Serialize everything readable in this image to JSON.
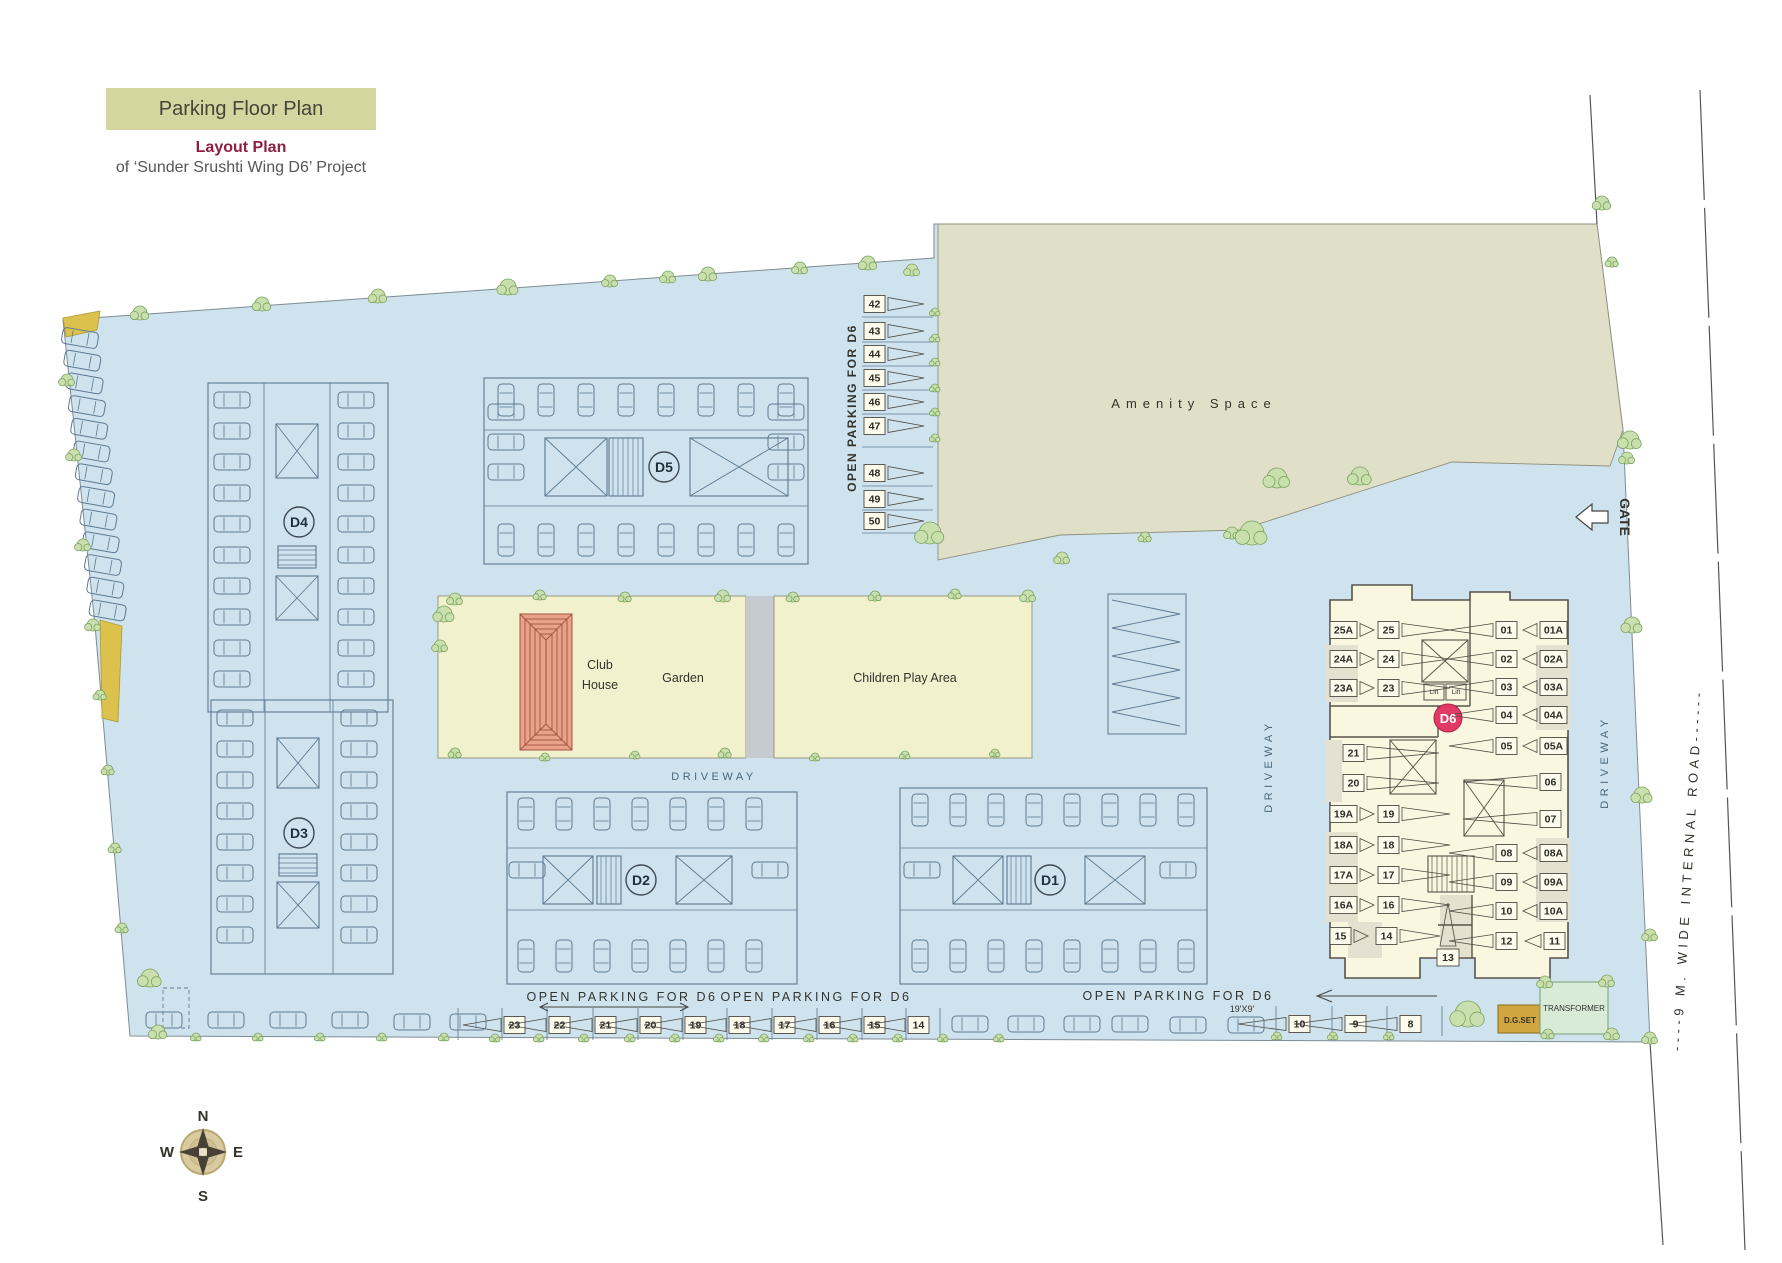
{
  "header": {
    "banner": "Parking Floor Plan",
    "subtitle_1": "Layout Plan",
    "subtitle_2": "of ‘Sunder Srushti Wing D6’ Project"
  },
  "labels": {
    "amenity_space": "Amenity Space",
    "club_house": [
      "Club",
      "House"
    ],
    "garden": "Garden",
    "children_play_area": "Children Play Area",
    "driveway": "DRIVEWAY",
    "gate": "GATE",
    "internal_road": "----9 M. WIDE INTERNAL ROAD------",
    "open_parking_for_d6": "OPEN PARKING FOR D6",
    "spot_dimension": "19'X9'",
    "dg_set": "D.G.SET",
    "transformer": "TRANSFORMER",
    "lift": "Lift"
  },
  "compass": {
    "north": "N",
    "east": "E",
    "south": "S",
    "west": "W"
  },
  "building_labels": {
    "d1": "D1",
    "d2": "D2",
    "d3": "D3",
    "d4": "D4",
    "d5": "D5",
    "d6": "D6"
  },
  "open_parking": {
    "side_column_spots": [
      "42",
      "43",
      "44",
      "45",
      "46",
      "47",
      "48",
      "49",
      "50"
    ],
    "bottom_row_spots": [
      "23",
      "22",
      "21",
      "20",
      "19",
      "18",
      "17",
      "16",
      "15",
      "14"
    ],
    "bottom_right_spots": [
      "10",
      "9",
      "8"
    ]
  },
  "d6_parking": {
    "top_left_spots": [
      [
        "25A",
        "25"
      ],
      [
        "24A",
        "24"
      ],
      [
        "23A",
        "23"
      ]
    ],
    "lower_left_spots": [
      [
        "21"
      ],
      [
        "20"
      ],
      [
        "19A",
        "19"
      ],
      [
        "18A",
        "18"
      ],
      [
        "17A",
        "17"
      ],
      [
        "16A",
        "16"
      ],
      [
        "15",
        "14"
      ]
    ],
    "center_spot": "13",
    "right_spots": [
      [
        "01",
        "01A"
      ],
      [
        "02",
        "02A"
      ],
      [
        "03",
        "03A"
      ],
      [
        "04",
        "04A"
      ],
      [
        "05",
        "05A"
      ],
      [
        "06"
      ],
      [
        "07"
      ],
      [
        "08",
        "08A"
      ],
      [
        "09",
        "09A"
      ],
      [
        "10",
        "10A"
      ],
      [
        "12",
        "11"
      ]
    ]
  },
  "colors": {
    "site": "#cfe3ee",
    "amenity": "#e0dfc8",
    "lawn": "#f1f2cd",
    "path": "#c6cbd0",
    "d6_fill": "#faf7e0",
    "d6_shaded": "#e5e1d0",
    "badge": "#e13a66",
    "banner_bg": "#d5d5a0",
    "title_red": "#8c2040",
    "roof": "#e8a289",
    "dg_set_bg": "#d2a63e",
    "transformer_bg": "#d7ebd7",
    "building_line": "#5b7a92"
  }
}
